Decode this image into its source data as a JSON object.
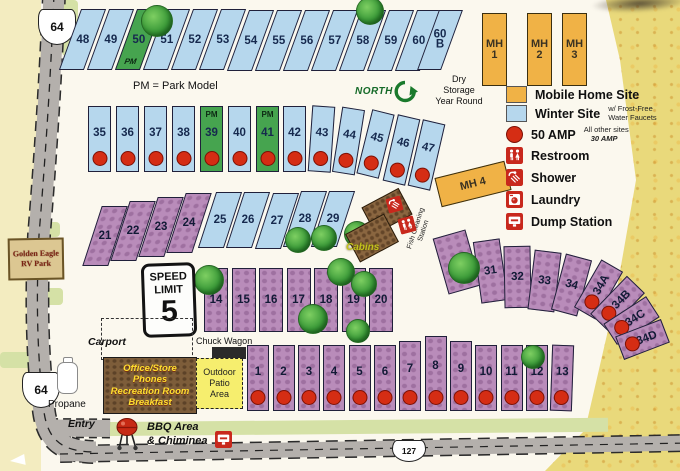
{
  "legend": {
    "items": [
      {
        "label": "Mobile Home Site"
      },
      {
        "label": "Winter Site",
        "note": "w/ Frost-Free\nWater Faucets"
      },
      {
        "label": "50 AMP",
        "note": "All other sites",
        "note2": "30 AMP"
      },
      {
        "label": "Restroom"
      },
      {
        "label": "Shower"
      },
      {
        "label": "Laundry"
      },
      {
        "label": "Dump Station"
      }
    ]
  },
  "signs": {
    "park_name": "Golden Eagle\nRV Park",
    "speed_top": "SPEED\nLIMIT",
    "speed_value": "5",
    "route_64_top": "64",
    "route_64_bottom": "64",
    "route_127": "127",
    "north": "NORTH"
  },
  "notes": {
    "park_model": "PM = Park Model",
    "dry_storage": "Dry\nStorage\nYear Round"
  },
  "places": {
    "carport": "Carport",
    "chuck_wagon": "Chuck Wagon",
    "office": "Office/Store\nPhones\nRecreation Room\nBreakfast",
    "outdoor_patio": "Outdoor\nPatio\nArea",
    "propane": "Propane",
    "entry": "Entry",
    "bbq": "BBQ Area\n& Chiminea",
    "cabins": "Cabins",
    "fish_cleaning": "Fish Cleaning\nStation"
  },
  "mobile_home_units": [
    {
      "label": "MH\n1",
      "x": 482,
      "y": 13,
      "w": 25,
      "h": 73,
      "r": 0
    },
    {
      "label": "MH\n2",
      "x": 527,
      "y": 13,
      "w": 25,
      "h": 73,
      "r": 0
    },
    {
      "label": "MH\n3",
      "x": 562,
      "y": 13,
      "w": 25,
      "h": 73,
      "r": 0
    },
    {
      "label": "MH 4",
      "x": 437,
      "y": 169,
      "w": 72,
      "h": 30,
      "r": -14
    }
  ],
  "sites": [
    {
      "l": "48",
      "t": "winter",
      "x": 70,
      "y": 9,
      "w": 25,
      "h": 61,
      "k": -20
    },
    {
      "l": "49",
      "t": "winter",
      "x": 98,
      "y": 9,
      "w": 25,
      "h": 61,
      "k": -20
    },
    {
      "l": "50",
      "t": "pmsite",
      "x": 126,
      "y": 9,
      "w": 25,
      "h": 61,
      "k": -20,
      "pm": "PM",
      "pp": "b"
    },
    {
      "l": "51",
      "t": "winter",
      "x": 154,
      "y": 9,
      "w": 25,
      "h": 61,
      "k": -20
    },
    {
      "l": "52",
      "t": "winter",
      "x": 182,
      "y": 9,
      "w": 25,
      "h": 61,
      "k": -20
    },
    {
      "l": "53",
      "t": "winter",
      "x": 210,
      "y": 9,
      "w": 25,
      "h": 61,
      "k": -20
    },
    {
      "l": "54",
      "t": "winter",
      "x": 238,
      "y": 10,
      "w": 25,
      "h": 61,
      "k": -20
    },
    {
      "l": "55",
      "t": "winter",
      "x": 266,
      "y": 10,
      "w": 25,
      "h": 61,
      "k": -20
    },
    {
      "l": "56",
      "t": "winter",
      "x": 294,
      "y": 10,
      "w": 25,
      "h": 61,
      "k": -20
    },
    {
      "l": "57",
      "t": "winter",
      "x": 322,
      "y": 10,
      "w": 25,
      "h": 61,
      "k": -20
    },
    {
      "l": "58",
      "t": "winter",
      "x": 350,
      "y": 10,
      "w": 25,
      "h": 61,
      "k": -20
    },
    {
      "l": "59",
      "t": "winter",
      "x": 378,
      "y": 10,
      "w": 25,
      "h": 61,
      "k": -20
    },
    {
      "l": "60",
      "t": "winter",
      "x": 406,
      "y": 10,
      "w": 25,
      "h": 61,
      "k": -20
    },
    {
      "l": "60\nB",
      "t": "winter",
      "x": 428,
      "y": 10,
      "w": 24,
      "h": 60,
      "k": -20
    },
    {
      "l": "35",
      "t": "winter",
      "x": 88,
      "y": 106,
      "w": 23,
      "h": 66,
      "d": 1
    },
    {
      "l": "36",
      "t": "winter",
      "x": 116,
      "y": 106,
      "w": 23,
      "h": 66,
      "d": 1
    },
    {
      "l": "37",
      "t": "winter",
      "x": 144,
      "y": 106,
      "w": 23,
      "h": 66,
      "d": 1
    },
    {
      "l": "38",
      "t": "winter",
      "x": 172,
      "y": 106,
      "w": 23,
      "h": 66,
      "d": 1
    },
    {
      "l": "39",
      "t": "pmsite",
      "x": 200,
      "y": 106,
      "w": 23,
      "h": 66,
      "d": 1,
      "pm": "PM",
      "pp": "t"
    },
    {
      "l": "40",
      "t": "winter",
      "x": 228,
      "y": 106,
      "w": 23,
      "h": 66,
      "d": 1
    },
    {
      "l": "41",
      "t": "pmsite",
      "x": 256,
      "y": 106,
      "w": 23,
      "h": 66,
      "d": 1,
      "pm": "PM",
      "pp": "t"
    },
    {
      "l": "42",
      "t": "winter",
      "x": 283,
      "y": 106,
      "w": 23,
      "h": 66,
      "d": 1
    },
    {
      "l": "43",
      "t": "winter",
      "x": 310,
      "y": 106,
      "w": 23,
      "h": 66,
      "d": 1,
      "r": 4
    },
    {
      "l": "44",
      "t": "winter",
      "x": 337,
      "y": 108,
      "w": 23,
      "h": 66,
      "d": 1,
      "r": 9
    },
    {
      "l": "45",
      "t": "winter",
      "x": 364,
      "y": 111,
      "w": 23,
      "h": 66,
      "d": 1,
      "r": 14
    },
    {
      "l": "46",
      "t": "winter",
      "x": 390,
      "y": 116,
      "w": 23,
      "h": 68,
      "d": 1,
      "r": 13
    },
    {
      "l": "47",
      "t": "winter",
      "x": 415,
      "y": 121,
      "w": 23,
      "h": 68,
      "d": 1,
      "r": 13
    },
    {
      "l": "21",
      "t": "purple",
      "x": 92,
      "y": 206,
      "w": 26,
      "h": 60,
      "k": -18,
      "lt": 1
    },
    {
      "l": "22",
      "t": "purple",
      "x": 120,
      "y": 201,
      "w": 26,
      "h": 60,
      "k": -18
    },
    {
      "l": "23",
      "t": "purple",
      "x": 148,
      "y": 197,
      "w": 26,
      "h": 60,
      "k": -18
    },
    {
      "l": "24",
      "t": "purple",
      "x": 176,
      "y": 193,
      "w": 26,
      "h": 60,
      "k": -18
    },
    {
      "l": "25",
      "t": "winter",
      "x": 207,
      "y": 192,
      "w": 26,
      "h": 56,
      "k": -18
    },
    {
      "l": "26",
      "t": "winter",
      "x": 235,
      "y": 192,
      "w": 26,
      "h": 56,
      "k": -18
    },
    {
      "l": "27",
      "t": "winter",
      "x": 264,
      "y": 193,
      "w": 26,
      "h": 56,
      "k": -18
    },
    {
      "l": "28",
      "t": "winter",
      "x": 292,
      "y": 191,
      "w": 26,
      "h": 56,
      "k": -18
    },
    {
      "l": "29",
      "t": "winter",
      "x": 320,
      "y": 191,
      "w": 26,
      "h": 56,
      "k": -18
    },
    {
      "l": "14",
      "t": "purple",
      "x": 204,
      "y": 268,
      "w": 24,
      "h": 64
    },
    {
      "l": "15",
      "t": "purple",
      "x": 231.5,
      "y": 268,
      "w": 24,
      "h": 64
    },
    {
      "l": "16",
      "t": "purple",
      "x": 259,
      "y": 268,
      "w": 24,
      "h": 64
    },
    {
      "l": "17",
      "t": "purple",
      "x": 286.5,
      "y": 268,
      "w": 24,
      "h": 64
    },
    {
      "l": "18",
      "t": "purple",
      "x": 314,
      "y": 268,
      "w": 24,
      "h": 64
    },
    {
      "l": "19",
      "t": "purple",
      "x": 341.5,
      "y": 268,
      "w": 24,
      "h": 64
    },
    {
      "l": "20",
      "t": "purple",
      "x": 369,
      "y": 268,
      "w": 24,
      "h": 64
    },
    {
      "l": "30",
      "t": "purple",
      "x": 440,
      "y": 233,
      "w": 34,
      "h": 58,
      "r": -16
    },
    {
      "l": "31",
      "t": "purple",
      "x": 477,
      "y": 240,
      "w": 27,
      "h": 62,
      "r": -8
    },
    {
      "l": "32",
      "t": "purple",
      "x": 504,
      "y": 246,
      "w": 27,
      "h": 62,
      "r": -1
    },
    {
      "l": "33",
      "t": "purple",
      "x": 531,
      "y": 251,
      "w": 27,
      "h": 60,
      "r": 7
    },
    {
      "l": "34",
      "t": "purple",
      "x": 558,
      "y": 256,
      "w": 27,
      "h": 58,
      "r": 15
    },
    {
      "l": "34A",
      "t": "purple",
      "x": 586,
      "y": 262,
      "w": 25,
      "h": 55,
      "r": 30,
      "d": 1,
      "al": 1
    },
    {
      "l": "34B",
      "t": "purple",
      "x": 605,
      "y": 277,
      "w": 25,
      "h": 53,
      "r": 44,
      "d": 1,
      "al": 1
    },
    {
      "l": "34C",
      "t": "purple",
      "x": 619,
      "y": 295,
      "w": 25,
      "h": 51,
      "r": 57,
      "d": 1,
      "al": 1
    },
    {
      "l": "34D",
      "t": "purple",
      "x": 630,
      "y": 315,
      "w": 25,
      "h": 49,
      "r": 69,
      "d": 1,
      "al": 1
    },
    {
      "l": "1",
      "t": "purple",
      "x": 247,
      "y": 345,
      "w": 22,
      "h": 66,
      "d": 1
    },
    {
      "l": "2",
      "t": "purple",
      "x": 272.5,
      "y": 345,
      "w": 22,
      "h": 66,
      "d": 1
    },
    {
      "l": "3",
      "t": "purple",
      "x": 298,
      "y": 345,
      "w": 22,
      "h": 66,
      "d": 1
    },
    {
      "l": "4",
      "t": "purple",
      "x": 323,
      "y": 345,
      "w": 22,
      "h": 66,
      "d": 1
    },
    {
      "l": "5",
      "t": "purple",
      "x": 348.5,
      "y": 345,
      "w": 22,
      "h": 66,
      "d": 1
    },
    {
      "l": "6",
      "t": "purple",
      "x": 374,
      "y": 345,
      "w": 22,
      "h": 66,
      "d": 1
    },
    {
      "l": "7",
      "t": "purple",
      "x": 399,
      "y": 341,
      "w": 22,
      "h": 70,
      "d": 1
    },
    {
      "l": "8",
      "t": "purple",
      "x": 424.5,
      "y": 336,
      "w": 22,
      "h": 75,
      "d": 1
    },
    {
      "l": "9",
      "t": "purple",
      "x": 450,
      "y": 341,
      "w": 22,
      "h": 70,
      "d": 1
    },
    {
      "l": "10",
      "t": "purple",
      "x": 475,
      "y": 345,
      "w": 22,
      "h": 66,
      "d": 1
    },
    {
      "l": "11",
      "t": "purple",
      "x": 500.5,
      "y": 345,
      "w": 22,
      "h": 66,
      "d": 1
    },
    {
      "l": "12",
      "t": "purple",
      "x": 526,
      "y": 345,
      "w": 22,
      "h": 66,
      "d": 1
    },
    {
      "l": "13",
      "t": "purple",
      "x": 551,
      "y": 345,
      "w": 22,
      "h": 66,
      "d": 1,
      "r": 2
    }
  ],
  "trees": [
    {
      "x": 156,
      "y": 20,
      "r": 15
    },
    {
      "x": 369,
      "y": 10,
      "r": 13
    },
    {
      "x": 297,
      "y": 239,
      "r": 12
    },
    {
      "x": 323,
      "y": 237,
      "r": 12
    },
    {
      "x": 356,
      "y": 233,
      "r": 12
    },
    {
      "x": 208,
      "y": 279,
      "r": 14
    },
    {
      "x": 340,
      "y": 271,
      "r": 13
    },
    {
      "x": 363,
      "y": 283,
      "r": 12
    },
    {
      "x": 312,
      "y": 318,
      "r": 14
    },
    {
      "x": 357,
      "y": 330,
      "r": 11
    },
    {
      "x": 463,
      "y": 267,
      "r": 15
    },
    {
      "x": 532,
      "y": 356,
      "r": 11
    }
  ],
  "icons": [
    {
      "name": "shower-icon",
      "type": "shower",
      "x": 387,
      "y": 197,
      "s": 15,
      "rot": -15
    },
    {
      "name": "restroom-icon",
      "type": "restroom",
      "x": 399,
      "y": 217,
      "s": 16,
      "rot": -15
    },
    {
      "name": "phone-icon",
      "type": "phone",
      "x": 106,
      "y": 396,
      "s": 16,
      "rot": 0
    },
    {
      "name": "laundry-icon",
      "type": "laundry",
      "x": 176,
      "y": 396,
      "s": 16,
      "rot": 0
    },
    {
      "name": "dump-station-icon",
      "type": "dump",
      "x": 215,
      "y": 431,
      "s": 17,
      "rot": 0
    }
  ]
}
